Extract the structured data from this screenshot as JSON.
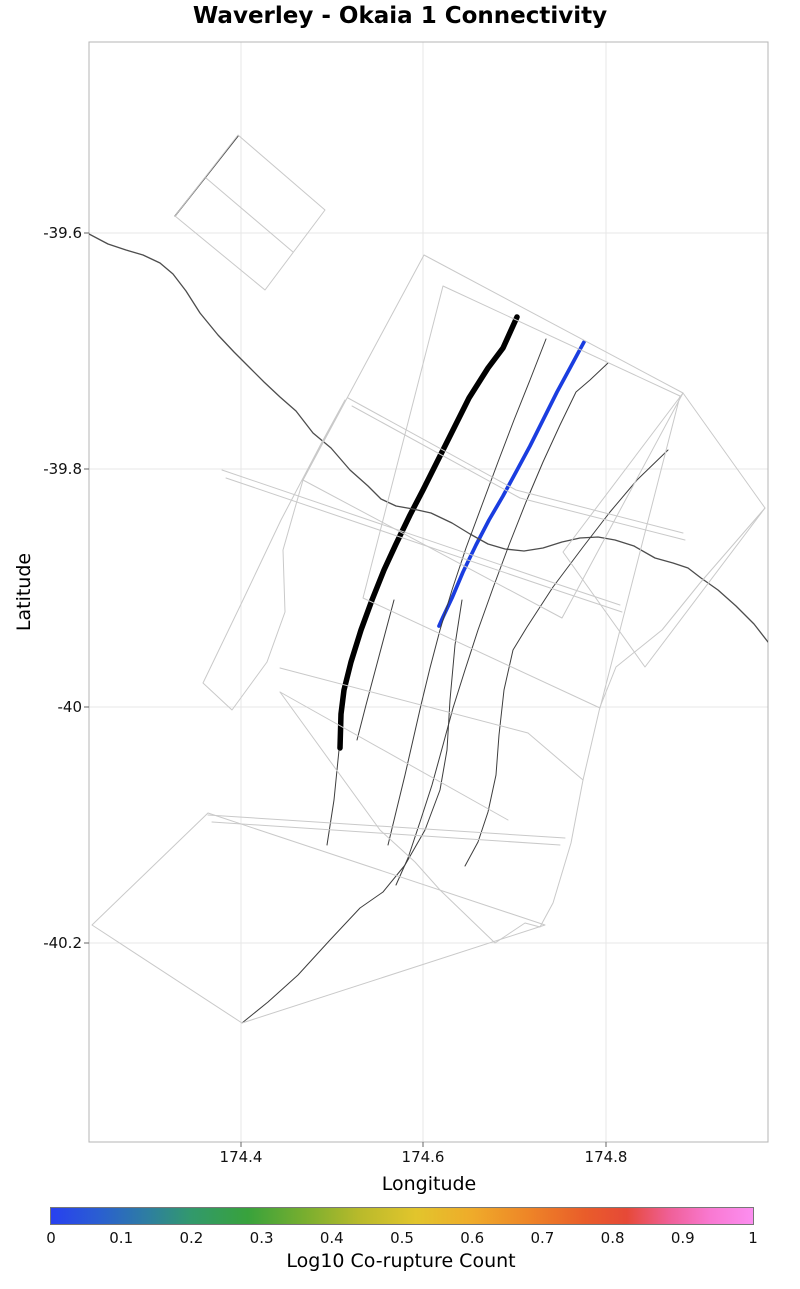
{
  "title": "Waverley - Okaia 1 Connectivity",
  "axes": {
    "x_label": "Longitude",
    "y_label": "Latitude",
    "x_ticks": [
      {
        "label": "174.4",
        "px": 241
      },
      {
        "label": "174.6",
        "px": 423
      },
      {
        "label": "174.8",
        "px": 606
      }
    ],
    "y_ticks": [
      {
        "label": "-39.6",
        "px": 233
      },
      {
        "label": "-39.8",
        "px": 469
      },
      {
        "label": "-40",
        "px": 707
      },
      {
        "label": "-40.2",
        "px": 943
      }
    ]
  },
  "colorbar": {
    "label": "Log10 Co-rupture Count",
    "tick_labels": [
      "0",
      "0.1",
      "0.2",
      "0.3",
      "0.4",
      "0.5",
      "0.6",
      "0.7",
      "0.8",
      "0.9",
      "1"
    ],
    "tick_values": [
      0,
      0.1,
      0.2,
      0.3,
      0.4,
      0.5,
      0.6,
      0.7,
      0.8,
      0.9,
      1
    ],
    "gradient_stops": [
      {
        "pos": 0,
        "color": "#2840f0"
      },
      {
        "pos": 0.07,
        "color": "#2a5fd0"
      },
      {
        "pos": 0.14,
        "color": "#2e7f9f"
      },
      {
        "pos": 0.2,
        "color": "#32996c"
      },
      {
        "pos": 0.28,
        "color": "#38a23c"
      },
      {
        "pos": 0.36,
        "color": "#77ae2f"
      },
      {
        "pos": 0.44,
        "color": "#b9ba2b"
      },
      {
        "pos": 0.52,
        "color": "#e2c52c"
      },
      {
        "pos": 0.6,
        "color": "#efab2a"
      },
      {
        "pos": 0.68,
        "color": "#ee8527"
      },
      {
        "pos": 0.76,
        "color": "#e95d2a"
      },
      {
        "pos": 0.82,
        "color": "#e64937"
      },
      {
        "pos": 0.88,
        "color": "#ef5f96"
      },
      {
        "pos": 0.94,
        "color": "#f979d2"
      },
      {
        "pos": 1,
        "color": "#fc8ef0"
      }
    ]
  },
  "chart_data": {
    "type": "map",
    "title": "Waverley - Okaia 1 Connectivity",
    "xlabel": "Longitude",
    "ylabel": "Latitude",
    "xlim": [
      174.23,
      174.98
    ],
    "ylim": [
      -40.37,
      -39.44
    ],
    "grid": true,
    "legend": "colorbar Log10 Co-rupture Count 0 to 1, rainbow blue-green-yellow-orange-pink",
    "notes": "Fault-trace connectivity map. Thick black trace = Waverley fault. Blue trace = Okaia 1 fault colored at Log10 co-rupture count 0. Thin dark lines = other fault traces; light gray outlines = fault surface-projection polygons. Points below are page pixel coordinates.",
    "plot_rect": {
      "x": 89,
      "y": 42,
      "w": 679,
      "h": 1100
    },
    "map_lines": [
      {
        "name": "waverley-fault-trace",
        "color": "#000000",
        "width": 5.5,
        "closed": false,
        "points": [
          [
            517,
            317
          ],
          [
            503,
            348
          ],
          [
            488,
            368
          ],
          [
            469,
            398
          ],
          [
            452,
            432
          ],
          [
            436,
            464
          ],
          [
            423,
            490
          ],
          [
            410,
            515
          ],
          [
            396,
            544
          ],
          [
            384,
            570
          ],
          [
            372,
            600
          ],
          [
            361,
            630
          ],
          [
            351,
            662
          ],
          [
            344,
            690
          ],
          [
            341,
            714
          ],
          [
            340,
            748
          ]
        ]
      },
      {
        "name": "okaia-1-fault-trace",
        "color": "#1a3de0",
        "width": 3.7,
        "closed": false,
        "points": [
          [
            584,
            342
          ],
          [
            570,
            368
          ],
          [
            557,
            392
          ],
          [
            544,
            418
          ],
          [
            530,
            446
          ],
          [
            516,
            472
          ],
          [
            503,
            496
          ],
          [
            489,
            520
          ],
          [
            476,
            545
          ],
          [
            463,
            572
          ],
          [
            452,
            598
          ],
          [
            443,
            617
          ],
          [
            439,
            626
          ]
        ]
      },
      {
        "name": "coastline",
        "color": "#4d4d4d",
        "width": 1.3,
        "closed": false,
        "points": [
          [
            89,
            234
          ],
          [
            108,
            244
          ],
          [
            126,
            250
          ],
          [
            143,
            255
          ],
          [
            160,
            263
          ],
          [
            173,
            274
          ],
          [
            186,
            291
          ],
          [
            200,
            313
          ],
          [
            218,
            335
          ],
          [
            234,
            352
          ],
          [
            250,
            368
          ],
          [
            264,
            382
          ],
          [
            280,
            397
          ],
          [
            296,
            411
          ],
          [
            313,
            433
          ],
          [
            331,
            448
          ],
          [
            350,
            470
          ],
          [
            368,
            486
          ],
          [
            381,
            499
          ],
          [
            396,
            506
          ],
          [
            413,
            509
          ],
          [
            431,
            513
          ],
          [
            452,
            523
          ],
          [
            470,
            534
          ],
          [
            488,
            544
          ],
          [
            505,
            549
          ],
          [
            524,
            551
          ],
          [
            543,
            548
          ],
          [
            562,
            542
          ],
          [
            580,
            538
          ],
          [
            598,
            537
          ],
          [
            615,
            540
          ],
          [
            634,
            546
          ],
          [
            655,
            558
          ],
          [
            673,
            563
          ],
          [
            688,
            568
          ],
          [
            701,
            578
          ],
          [
            718,
            590
          ],
          [
            736,
            606
          ],
          [
            754,
            624
          ],
          [
            768,
            642
          ]
        ]
      },
      {
        "name": "fault-trace-nw",
        "color": "#404040",
        "width": 1.4,
        "closed": false,
        "points": [
          [
            175,
            216
          ],
          [
            238,
            136
          ]
        ]
      },
      {
        "name": "fault-trace-a",
        "color": "#3d3d3d",
        "width": 1,
        "closed": false,
        "points": [
          [
            546,
            339
          ],
          [
            530,
            380
          ],
          [
            514,
            420
          ],
          [
            498,
            462
          ],
          [
            482,
            505
          ],
          [
            466,
            548
          ],
          [
            452,
            590
          ],
          [
            440,
            630
          ],
          [
            430,
            668
          ],
          [
            421,
            705
          ],
          [
            413,
            740
          ],
          [
            405,
            775
          ],
          [
            396,
            812
          ],
          [
            388,
            845
          ]
        ]
      },
      {
        "name": "fault-trace-b",
        "color": "#3d3d3d",
        "width": 1,
        "closed": false,
        "points": [
          [
            608,
            363
          ],
          [
            590,
            380
          ],
          [
            576,
            392
          ],
          [
            560,
            425
          ],
          [
            543,
            462
          ],
          [
            526,
            502
          ],
          [
            509,
            545
          ],
          [
            493,
            588
          ],
          [
            478,
            630
          ],
          [
            465,
            670
          ],
          [
            453,
            708
          ],
          [
            443,
            745
          ],
          [
            432,
            785
          ],
          [
            420,
            822
          ],
          [
            408,
            858
          ],
          [
            396,
            885
          ]
        ]
      },
      {
        "name": "fault-trace-long-sw",
        "color": "#3d3d3d",
        "width": 1,
        "closed": false,
        "points": [
          [
            462,
            600
          ],
          [
            455,
            645
          ],
          [
            450,
            700
          ],
          [
            447,
            750
          ],
          [
            440,
            790
          ],
          [
            425,
            830
          ],
          [
            405,
            865
          ],
          [
            383,
            892
          ],
          [
            360,
            908
          ],
          [
            330,
            940
          ],
          [
            298,
            975
          ],
          [
            268,
            1002
          ],
          [
            242,
            1023
          ]
        ]
      },
      {
        "name": "fault-trace-east-diagonal",
        "color": "#3d3d3d",
        "width": 1,
        "closed": false,
        "points": [
          [
            668,
            450
          ],
          [
            637,
            480
          ],
          [
            610,
            512
          ],
          [
            583,
            547
          ],
          [
            553,
            587
          ],
          [
            527,
            627
          ],
          [
            513,
            650
          ],
          [
            504,
            690
          ],
          [
            499,
            735
          ],
          [
            496,
            775
          ],
          [
            488,
            812
          ],
          [
            478,
            842
          ],
          [
            465,
            866
          ]
        ]
      },
      {
        "name": "fault-trace-below-waverley",
        "color": "#3d3d3d",
        "width": 1,
        "closed": false,
        "points": [
          [
            339,
            750
          ],
          [
            334,
            800
          ],
          [
            327,
            845
          ]
        ]
      },
      {
        "name": "fault-trace-short-steep",
        "color": "#3d3d3d",
        "width": 1,
        "closed": false,
        "points": [
          [
            394,
            600
          ],
          [
            378,
            660
          ],
          [
            366,
            705
          ],
          [
            357,
            740
          ]
        ]
      },
      {
        "name": "projection-nw-rect",
        "color": "#c9c9c9",
        "width": 1,
        "closed": true,
        "points": [
          [
            175,
            216
          ],
          [
            238,
            135
          ],
          [
            325,
            210
          ],
          [
            265,
            290
          ]
        ]
      },
      {
        "name": "projection-nw-rect-divider",
        "color": "#c9c9c9",
        "width": 1,
        "closed": false,
        "points": [
          [
            206,
            178
          ],
          [
            293,
            252
          ]
        ]
      },
      {
        "name": "projection-central-rect-1",
        "color": "#c9c9c9",
        "width": 1,
        "closed": true,
        "points": [
          [
            424,
            255
          ],
          [
            683,
            393
          ],
          [
            562,
            618
          ],
          [
            303,
            480
          ]
        ]
      },
      {
        "name": "projection-central-rect-2",
        "color": "#c9c9c9",
        "width": 1,
        "closed": true,
        "points": [
          [
            443,
            286
          ],
          [
            680,
            396
          ],
          [
            600,
            708
          ],
          [
            363,
            598
          ]
        ]
      },
      {
        "name": "projection-east-diamond",
        "color": "#c9c9c9",
        "width": 1,
        "closed": true,
        "points": [
          [
            683,
            393
          ],
          [
            765,
            508
          ],
          [
            645,
            667
          ],
          [
            563,
            552
          ]
        ]
      },
      {
        "name": "projection-sw-parallelogram",
        "color": "#c9c9c9",
        "width": 1,
        "closed": true,
        "points": [
          [
            92,
            925
          ],
          [
            208,
            813
          ],
          [
            545,
            925
          ],
          [
            242,
            1023
          ]
        ]
      },
      {
        "name": "projection-west-strip",
        "color": "#c9c9c9",
        "width": 1,
        "closed": true,
        "points": [
          [
            345,
            400
          ],
          [
            303,
            480
          ],
          [
            283,
            550
          ],
          [
            285,
            612
          ],
          [
            267,
            662
          ],
          [
            232,
            710
          ],
          [
            203,
            683
          ],
          [
            243,
            600
          ],
          [
            281,
            520
          ],
          [
            322,
            442
          ]
        ]
      },
      {
        "name": "projection-south-boundary",
        "color": "#c9c9c9",
        "width": 1,
        "closed": false,
        "points": [
          [
            765,
            508
          ],
          [
            700,
            583
          ],
          [
            662,
            630
          ],
          [
            616,
            667
          ],
          [
            600,
            707
          ],
          [
            583,
            780
          ],
          [
            571,
            843
          ],
          [
            553,
            903
          ],
          [
            540,
            927
          ],
          [
            525,
            923
          ],
          [
            495,
            943
          ],
          [
            440,
            890
          ],
          [
            415,
            862
          ],
          [
            380,
            830
          ],
          [
            280,
            692
          ]
        ]
      },
      {
        "name": "projection-mid-strip-1a",
        "color": "#c9c9c9",
        "width": 1,
        "closed": false,
        "points": [
          [
            348,
            398
          ],
          [
            516,
            490
          ],
          [
            683,
            533
          ]
        ]
      },
      {
        "name": "projection-mid-strip-1b",
        "color": "#c9c9c9",
        "width": 1,
        "closed": false,
        "points": [
          [
            352,
            406
          ],
          [
            520,
            498
          ],
          [
            685,
            540
          ]
        ]
      },
      {
        "name": "projection-mid-strip-2a",
        "color": "#c9c9c9",
        "width": 1,
        "closed": false,
        "points": [
          [
            222,
            470
          ],
          [
            560,
            585
          ],
          [
            620,
            605
          ]
        ]
      },
      {
        "name": "projection-mid-strip-2b",
        "color": "#c9c9c9",
        "width": 1,
        "closed": false,
        "points": [
          [
            226,
            478
          ],
          [
            562,
            592
          ],
          [
            622,
            612
          ]
        ]
      },
      {
        "name": "projection-low-strip-a",
        "color": "#c9c9c9",
        "width": 1,
        "closed": false,
        "points": [
          [
            208,
            815
          ],
          [
            565,
            838
          ]
        ]
      },
      {
        "name": "projection-low-strip-b",
        "color": "#c9c9c9",
        "width": 1,
        "closed": false,
        "points": [
          [
            212,
            822
          ],
          [
            560,
            845
          ]
        ]
      },
      {
        "name": "projection-low-strip-c",
        "color": "#c9c9c9",
        "width": 1,
        "closed": false,
        "points": [
          [
            280,
            668
          ],
          [
            528,
            733
          ],
          [
            583,
            780
          ]
        ]
      },
      {
        "name": "projection-low-strip-d",
        "color": "#c9c9c9",
        "width": 1,
        "closed": false,
        "points": [
          [
            280,
            692
          ],
          [
            508,
            820
          ]
        ]
      }
    ]
  },
  "style_colors": {
    "grid": "#e7e7e7",
    "plot_border": "#b5b5b5",
    "tick_mark": "#666666"
  }
}
